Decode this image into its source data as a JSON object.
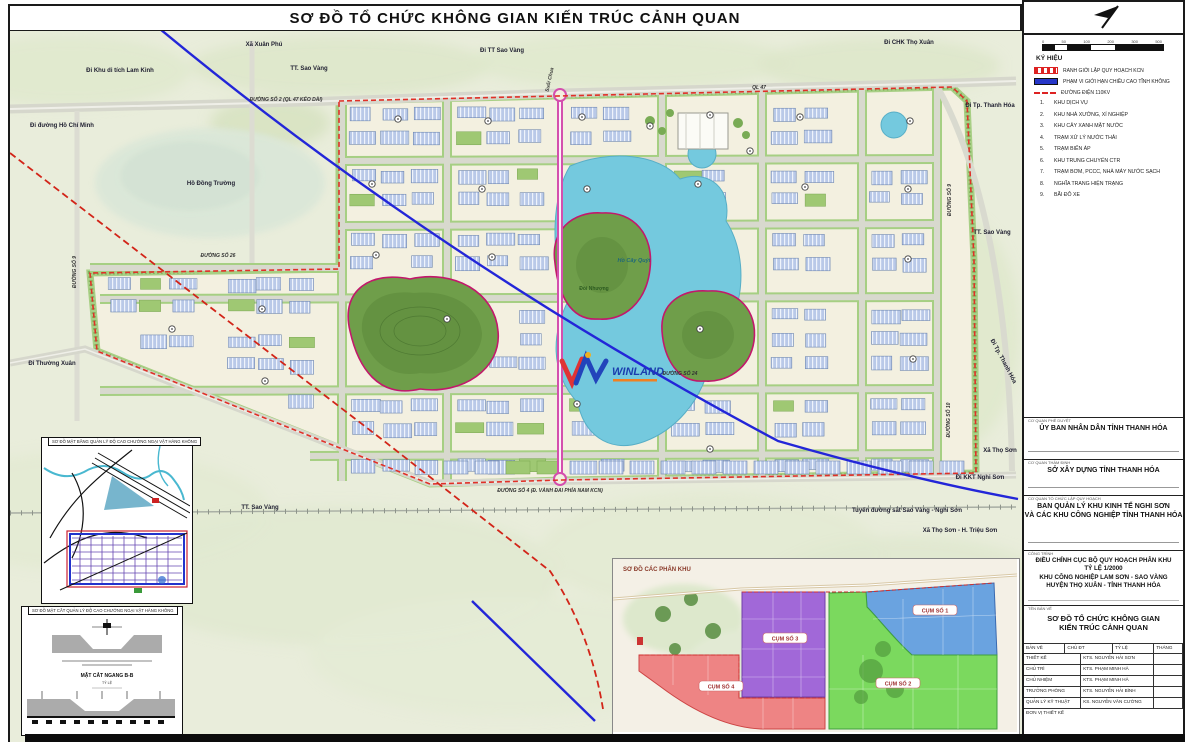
{
  "title": "SƠ ĐỒ TỔ CHỨC KHÔNG GIAN KIẾN TRÚC CẢNH QUAN",
  "scalebar": {
    "ticks": [
      "0",
      "50",
      "100",
      "200",
      "300",
      "500"
    ]
  },
  "legend": {
    "heading": "KÝ HIỆU",
    "lines": [
      {
        "swatch": "sw-boundary",
        "label": "RANH GIỚI LẬP QUY HOẠCH  KCN"
      },
      {
        "swatch": "sw-blue",
        "label": "PHẠM VI GIỚI HẠN CHIỀU CAO TĨNH KHÔNG"
      },
      {
        "swatch": "sw-110kv",
        "label": "ĐƯỜNG ĐIỆN 110KV"
      }
    ],
    "items": [
      {
        "num": "1.",
        "label": "KHU DỊCH VỤ"
      },
      {
        "num": "2.",
        "label": "KHU NHÀ XƯỞNG, XÍ NGHIỆP"
      },
      {
        "num": "3.",
        "label": "KHU CÂY XANH MẶT NƯỚC"
      },
      {
        "num": "4.",
        "label": "TRẠM XỬ LÝ NƯỚC THẢI"
      },
      {
        "num": "5.",
        "label": "TRẠM BIẾN ÁP"
      },
      {
        "num": "6.",
        "label": "KHU TRUNG CHUYỂN CTR"
      },
      {
        "num": "7.",
        "label": "TRẠM BƠM, PCCC, NHÀ MÁY NƯỚC SẠCH"
      },
      {
        "num": "8.",
        "label": "NGHĨA TRANG HIỆN TRẠNG"
      },
      {
        "num": "9.",
        "label": "BÃI ĐỖ XE"
      }
    ]
  },
  "panel": {
    "blocks": [
      {
        "heading": "CƠ QUAN PHÊ DUYỆT",
        "lines": [
          "ỦY BAN NHÂN DÂN TỈNH THANH HÓA"
        ]
      },
      {
        "heading": "CƠ QUAN THẨM ĐỊNH",
        "lines": [
          "SỞ XÂY DỰNG TỈNH THANH HÓA"
        ]
      },
      {
        "heading": "CƠ QUAN TỔ CHỨC LẬP QUY HOẠCH",
        "lines": [
          "BAN QUẢN LÝ KHU KINH TẾ NGHI SƠN",
          "VÀ CÁC KHU CÔNG NGHIỆP TỈNH THANH HÓA"
        ]
      },
      {
        "heading": "CÔNG TRÌNH",
        "lines": [
          "ĐIỀU CHỈNH CỤC BỘ QUY HOẠCH PHÂN KHU",
          "TỶ LỆ 1/2000",
          "KHU CÔNG NGHIỆP LAM SƠN - SAO VÀNG",
          "HUYỆN THỌ XUÂN - TỈNH THANH HÓA"
        ]
      }
    ],
    "drawing_name": {
      "heading": "TÊN BẢN VẼ",
      "lines": [
        "SƠ ĐỒ TỔ CHỨC KHÔNG GIAN",
        "KIẾN TRÚC CẢNH QUAN"
      ]
    },
    "sign_table": {
      "header": [
        "BẢN VẼ",
        "CHỦ ĐT",
        "TỶ LỆ",
        "THÁNG"
      ],
      "rows": [
        [
          "THIẾT KẾ",
          "KTS. NGUYỄN HẢI SƠN"
        ],
        [
          "CHỦ TRÌ",
          "KTS. PHẠM MINH HÀ"
        ],
        [
          "CHỦ NHIỆM",
          "KTS. PHẠM MINH HÀ"
        ],
        [
          "TRƯỞNG PHÒNG",
          "KTS. NGUYỄN HẢI BÌNH"
        ],
        [
          "QUẢN LÝ KỸ THUẬT",
          "KS. NGUYỄN VĂN CƯỜNG"
        ]
      ],
      "footer": "ĐƠN VỊ THIẾT KẾ"
    }
  },
  "insets": {
    "aviation_plan": {
      "title": "SƠ ĐỒ MẶT BẰNG QUẢN LÝ ĐỘ CAO CHƯỚNG NGẠI VẬT HÀNG KHÔNG"
    },
    "aviation_section": {
      "title": "SƠ ĐỒ MẶT CẮT QUẢN LÝ ĐỘ CAO CHƯỚNG NGẠI VẬT HÀNG KHÔNG",
      "label": "MẶT CẮT NGANG B-B",
      "sub": "TỶ LỆ"
    },
    "clusters": {
      "title": "SƠ ĐỒ CÁC PHÂN KHU",
      "zones": [
        {
          "label": "CỤM SỐ 1",
          "color": "#6aa3e0"
        },
        {
          "label": "CỤM SỐ 2",
          "color": "#7bd95e"
        },
        {
          "label": "CỤM SỐ 3",
          "color": "#a168d8"
        },
        {
          "label": "CỤM SỐ 4",
          "color": "#ee8484"
        }
      ]
    }
  },
  "logo": {
    "name": "WINLAND"
  },
  "map_labels": [
    {
      "t": "Xã Xuân Phú",
      "x": 262,
      "y": 46,
      "c": "pl"
    },
    {
      "t": "Đi Khu di tích Lam Kinh",
      "x": 118,
      "y": 72,
      "c": "pl"
    },
    {
      "t": "TT. Sao Vàng",
      "x": 307,
      "y": 70,
      "c": "pl"
    },
    {
      "t": "Đi TT Sao Vàng",
      "x": 500,
      "y": 52,
      "c": "pl"
    },
    {
      "t": "Đi CHK Thọ Xuân",
      "x": 907,
      "y": 44,
      "c": "pl"
    },
    {
      "t": "ĐƯỜNG SỐ 2 (QL 47 KÉO DÀI)",
      "x": 284,
      "y": 101,
      "c": "rd"
    },
    {
      "t": "Đi đường Hồ Chí Minh",
      "x": 60,
      "y": 127,
      "c": "pl"
    },
    {
      "t": "QL 47",
      "x": 757,
      "y": 89,
      "c": "rd"
    },
    {
      "t": "Đi Tp. Thanh Hóa",
      "x": 988,
      "y": 107,
      "c": "pl"
    },
    {
      "t": "Hồ Đồng Trường",
      "x": 209,
      "y": 185,
      "c": "pl"
    },
    {
      "t": "Suối Chua",
      "x": 549,
      "y": 80,
      "c": "rd",
      "r": -78
    },
    {
      "t": "ĐƯỜNG SỐ 26",
      "x": 216,
      "y": 257,
      "c": "rd"
    },
    {
      "t": "Đi Thường Xuân",
      "x": 50,
      "y": 365,
      "c": "pl"
    },
    {
      "t": "TT. Sao Vàng",
      "x": 990,
      "y": 234,
      "c": "pl"
    },
    {
      "t": "Đi Tp. Thanh Hóa",
      "x": 1000,
      "y": 362,
      "c": "pl",
      "r": 62
    },
    {
      "t": "Xã Thọ Sơn",
      "x": 998,
      "y": 452,
      "c": "pl"
    },
    {
      "t": "Đi KKT Nghi Sơn",
      "x": 978,
      "y": 479,
      "c": "pl"
    },
    {
      "t": "Tuyến đường sắt Sao Vàng - Nghi Sơn",
      "x": 905,
      "y": 512,
      "c": "pl"
    },
    {
      "t": "Xã Thọ Sơn - H. Triệu Sơn",
      "x": 958,
      "y": 532,
      "c": "pl"
    },
    {
      "t": "TT. Sao Vàng",
      "x": 258,
      "y": 509,
      "c": "pl"
    },
    {
      "t": "ĐƯỜNG SỐ 4 (Đ. VÀNH ĐAI PHÍA NAM KCN)",
      "x": 548,
      "y": 492,
      "c": "rd"
    },
    {
      "t": "Hồ Cây Quýt",
      "x": 632,
      "y": 262,
      "c": "lk"
    },
    {
      "t": "Đồi Nhượng",
      "x": 592,
      "y": 290,
      "c": "hl"
    },
    {
      "t": "ĐƯỜNG SỐ 24",
      "x": 678,
      "y": 375,
      "c": "rd"
    },
    {
      "t": "ĐƯỜNG SỐ 9",
      "x": 74,
      "y": 272,
      "c": "rd",
      "r": -90
    },
    {
      "t": "ĐƯỜNG SỐ 9",
      "x": 949,
      "y": 200,
      "c": "rd",
      "r": -90
    },
    {
      "t": "ĐƯỜNG SỐ 10",
      "x": 948,
      "y": 420,
      "c": "rd",
      "r": -90
    }
  ]
}
